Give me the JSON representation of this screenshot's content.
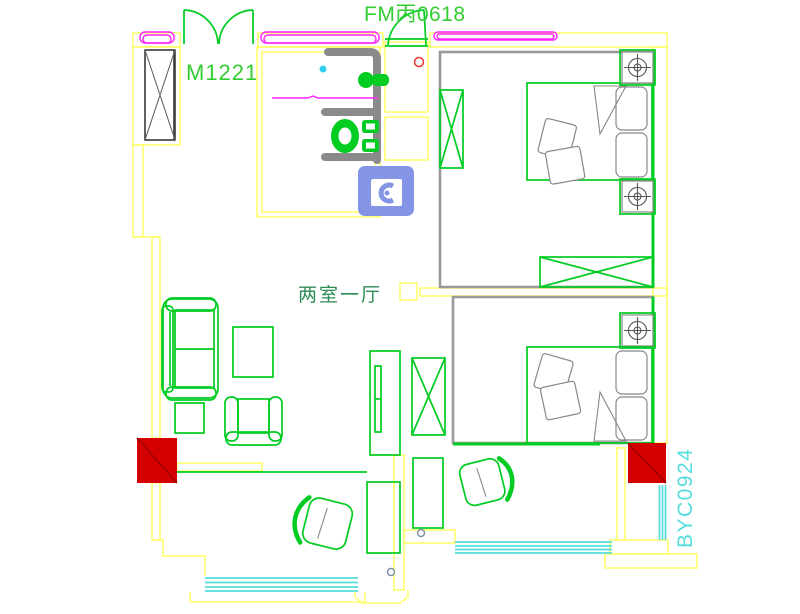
{
  "drawing": {
    "type": "apartment-floor-plan",
    "labels": {
      "door_main": "M1221",
      "door_fire": "FM丙0618",
      "room_type": "两室一厅",
      "window_code": "BYC0924"
    },
    "colors": {
      "wall_yellow": "#ffff66",
      "furniture_green": "#00cc22",
      "label_green": "#33cc33",
      "label_dark_green": "#2e8b57",
      "label_cyan": "#55dddd",
      "window_cyan": "#55dddd",
      "trim_magenta": "#ff22ff",
      "column_red": "#d40000",
      "column_red_dark": "#a00000",
      "fixture_gray": "#8a8a8a",
      "bedroom_wall_gray": "#9a9a9a",
      "washer_blue": "#8495e5"
    }
  }
}
